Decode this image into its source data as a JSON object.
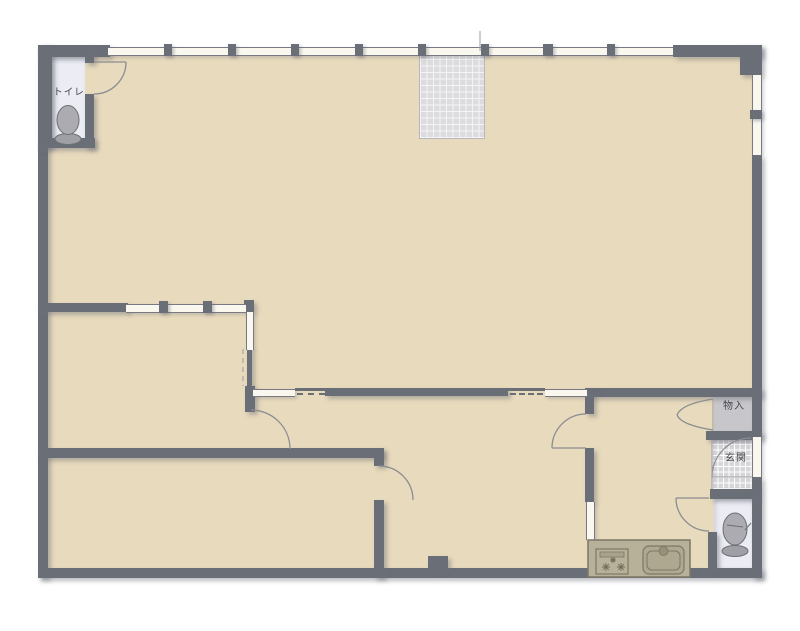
{
  "labels": {
    "toilet": "トイレ",
    "storage": "物入",
    "entrance": "玄関"
  },
  "colors": {
    "background": "#FFFFFF",
    "wall": "#6A6E76",
    "floor": "#E8DABC",
    "toilet_floor": "#ECEDF4",
    "entrance_tile": "#D6D6D9",
    "closet_fill": "#C7C7CB",
    "balcony_grid": "#DCDCDE",
    "kitchen_counter": "#B7B199",
    "door_arc": "#8B8D92"
  },
  "icons": {
    "toilet_top_left": "toilet-icon",
    "toilet_bottom_right": "toilet-icon",
    "stove": "stove-burners-icon",
    "sink": "kitchen-sink-icon"
  }
}
